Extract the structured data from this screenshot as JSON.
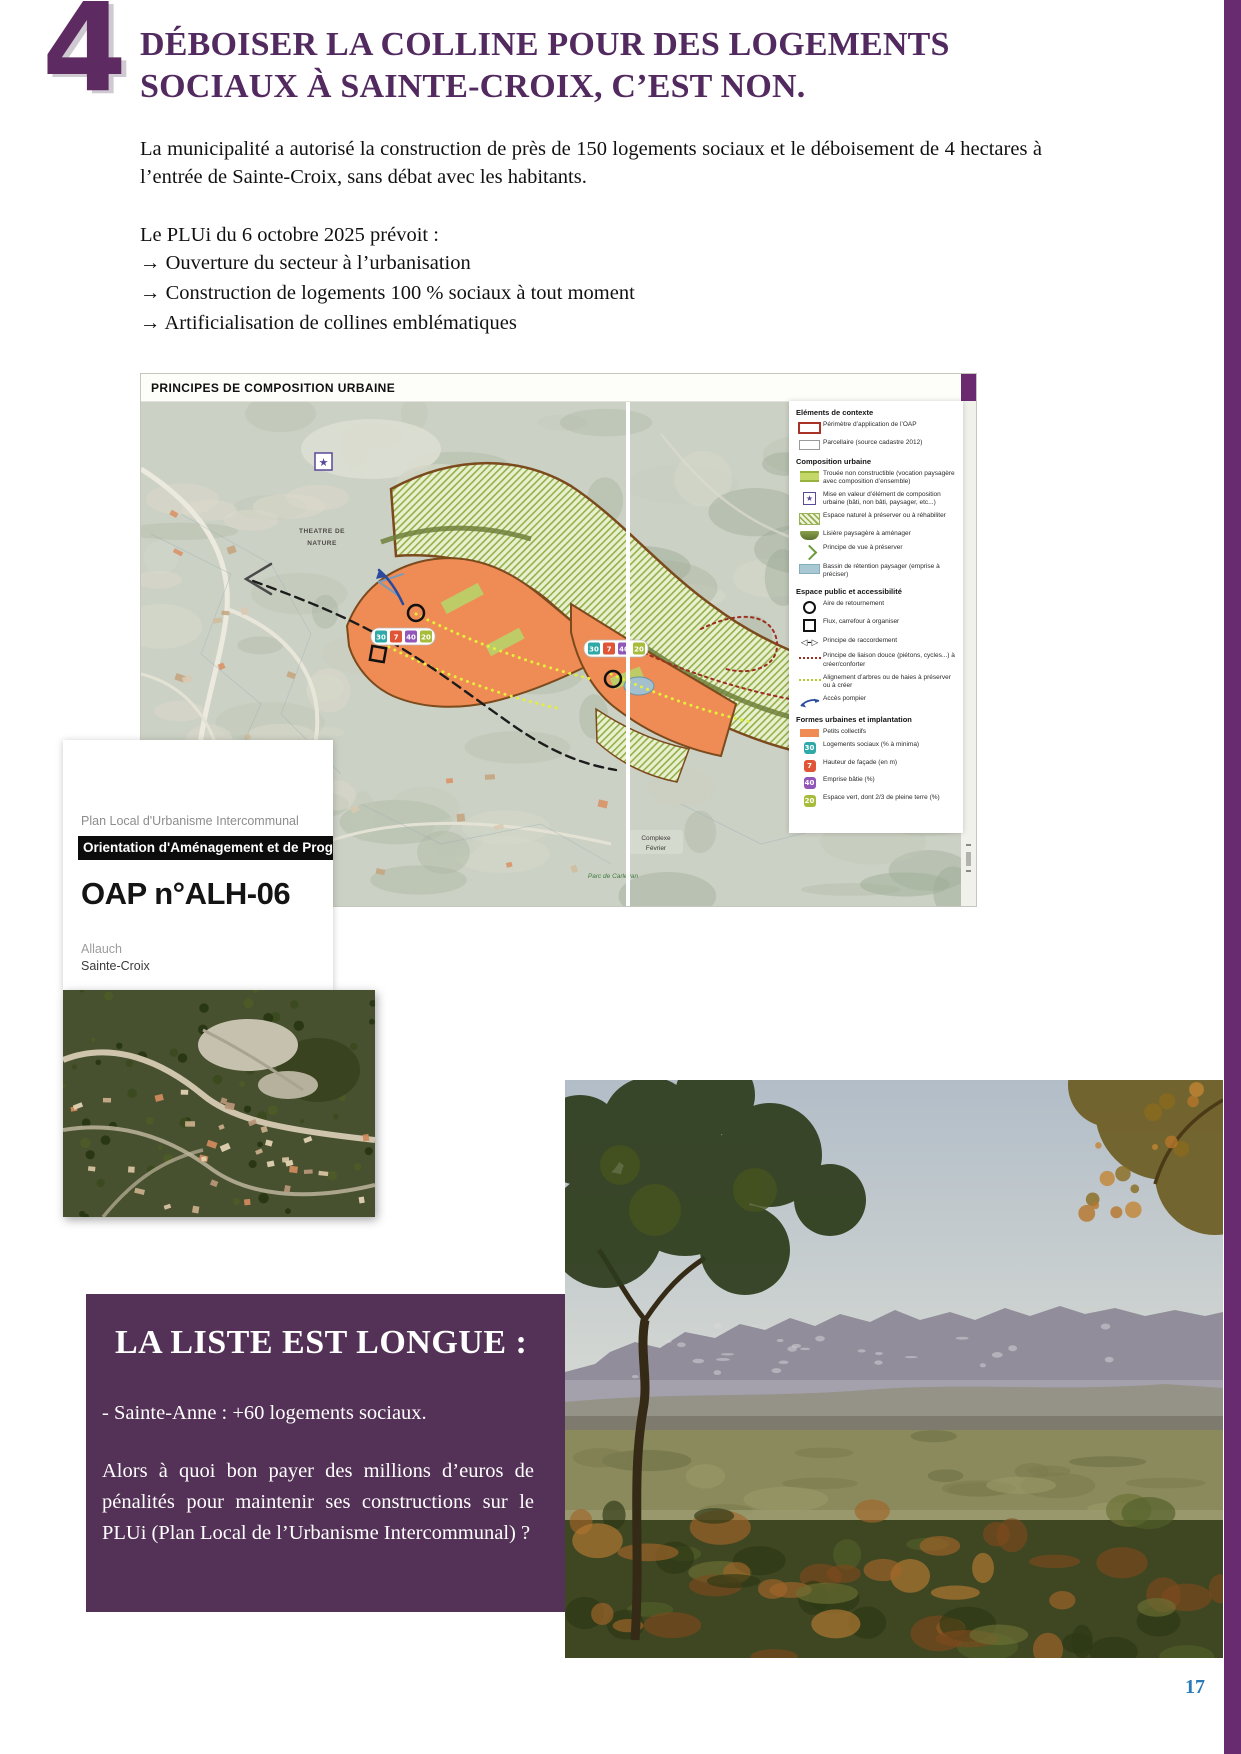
{
  "page": {
    "number": "17"
  },
  "header": {
    "section_number": "4",
    "title_line1": "DÉBOISER LA COLLINE POUR DES LOGEMENTS",
    "title_line2": "SOCIAUX À SAINTE-CROIX, C’EST NON."
  },
  "intro": {
    "paragraph": "La municipalité a autorisé la construction de près de 150 logements sociaux et le déboisement de 4 hectares à l’entrée de Sainte-Croix, sans débat avec les habitants.",
    "lead": "Le PLUi du 6 octobre 2025 prévoit :",
    "bullets": [
      "→ Ouverture du secteur à l’urbanisation",
      "→ Construction de logements 100 % sociaux à tout moment",
      "→ Artificialisation de collines emblématiques"
    ]
  },
  "map": {
    "title": "PRINCIPES DE COMPOSITION URBAINE",
    "labels": {
      "theatre_line1": "THEATRE DE",
      "theatre_line2": "NATURE",
      "complexe_line1": "Complexe",
      "complexe_line2": "Février",
      "parc": "Parc de Carlevan"
    },
    "badges": [
      "30",
      "7",
      "40",
      "20"
    ],
    "legend": {
      "sections": [
        {
          "title": "Eléments de contexte",
          "items": [
            {
              "icon": "perimeter-swatch",
              "label": "Périmètre d’application de l’OAP"
            },
            {
              "icon": "parcel-swatch",
              "label": "Parcellaire (source cadastre 2012)"
            }
          ]
        },
        {
          "title": "Composition urbaine",
          "items": [
            {
              "icon": "trouee-swatch",
              "label": "Trouée non constructible (vocation paysagère avec composition d’ensemble)"
            },
            {
              "icon": "star-swatch",
              "label": "Mise en valeur d’élément de composition urbaine (bâti, non bâti, paysager, etc...)"
            },
            {
              "icon": "hatch-swatch",
              "label": "Espace naturel à préserver ou à réhabiliter"
            },
            {
              "icon": "lisiere-swatch",
              "label": "Lisière paysagère à aménager"
            },
            {
              "icon": "vue-arrow",
              "label": "Principe de vue à préserver"
            },
            {
              "icon": "bassin-swatch",
              "label": "Bassin de rétention paysager (emprise à préciser)"
            }
          ]
        },
        {
          "title": "Espace public et accessibilité",
          "items": [
            {
              "icon": "circle-marker",
              "label": "Aire de retournement"
            },
            {
              "icon": "square-marker",
              "label": "Flux, carrefour à organiser"
            },
            {
              "icon": "raccord-arrows",
              "label": "Principe de raccordement"
            },
            {
              "icon": "liaison-dots",
              "label": "Principe de liaison douce (piétons, cycles...) à créer/conforter"
            },
            {
              "icon": "alignement-dots",
              "label": "Alignement d’arbres ou de haies à préserver ou à créer"
            },
            {
              "icon": "pompier-arrow",
              "label": "Accès pompier"
            }
          ]
        },
        {
          "title": "Formes urbaines et implantation",
          "items": [
            {
              "icon": "collectif-swatch",
              "label": "Petits collectifs"
            },
            {
              "icon": "badge-teal",
              "label": "Logements sociaux (% à minima)"
            },
            {
              "icon": "badge-red",
              "label": "Hauteur de façade (en m)"
            },
            {
              "icon": "badge-purple",
              "label": "Emprise bâtie (%)"
            },
            {
              "icon": "badge-green",
              "label": "Espace vert, dont 2/3 de pleine terre (%)"
            }
          ]
        }
      ]
    }
  },
  "oap_card": {
    "kicker": "Plan Local d'Urbanisme Intercommunal",
    "banner": "Orientation d'Aménagement et de Programmation",
    "code": "OAP n°ALH-06",
    "commune": "Allauch",
    "district": "Sainte-Croix"
  },
  "liste_box": {
    "title": "LA LISTE EST LONGUE :",
    "item": "- Sainte-Anne : +60 logements sociaux.",
    "paragraph": "Alors à quoi bon payer des millions d’euros de pénalités pour maintenir ses constructions sur le PLUi (Plan Local de l’Urbanisme Intercommunal) ?"
  },
  "colors": {
    "accent_purple": "#522a60",
    "box_purple": "#543156",
    "border_purple": "#682b6f",
    "plan_orange": "#ef8b54",
    "page_number_blue": "#2b7ab8"
  }
}
